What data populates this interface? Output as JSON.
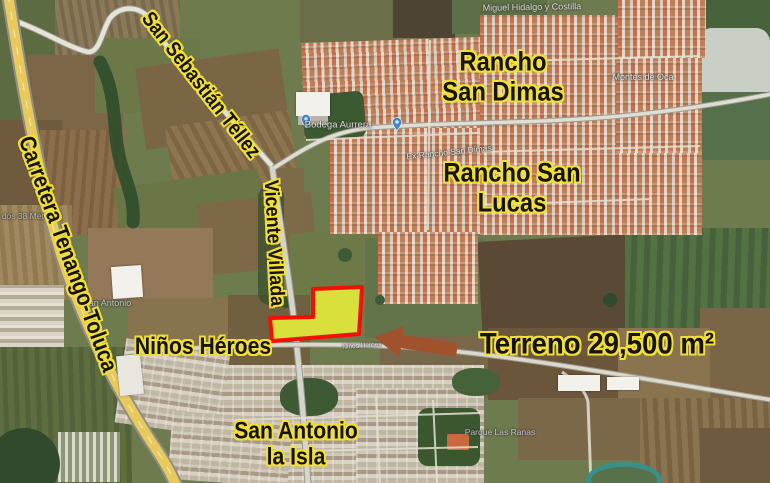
{
  "map_labels": {
    "carretera_tenango_toluca": "Carretera Tenango-Toluca",
    "san_sebastian_tellez": "San Sebastián Téllez",
    "vicente_villada": "Vicente Villada",
    "rancho_san_dimas_line1": "Rancho",
    "rancho_san_dimas_line2": "San Dimas",
    "rancho_san_lucas_line1": "Rancho San",
    "rancho_san_lucas_line2": "Lucas",
    "ninos_heroes": "Niños Héroes",
    "san_antonio_line1": "San Antonio",
    "san_antonio_line2": "la Isla",
    "terreno_area": "Terreno 29,500 m²"
  },
  "street_labels": {
    "miguel_hidalgo": "Miguel Hidalgo y Costilla",
    "montes_de_oca": "Montes de Oca",
    "bodega_aurrera": "Bodega Aurrera",
    "ex_rancho": "Ex Rancho San Dimas",
    "metepec": "dos 38 Metepec",
    "san_antonio_small": "San Antonio",
    "parque_las_ranas": "Parque Las Ranas",
    "ninos_heroes_street": "Niños Heroes"
  },
  "parcel": {
    "label": "terreno-29500-m2-highlight",
    "points": "313,289 362,287 359,334 272,341 270,318 313,317",
    "fill": "#d9e03c",
    "stroke": "#f50f00"
  },
  "arrow": {
    "points": "374,337 404,326 403,335 458,343 456,357 401,348 399,357",
    "color": "#a0522d"
  },
  "colors": {
    "label_outline": "#f0df3a",
    "highway": "#e7c95c"
  }
}
